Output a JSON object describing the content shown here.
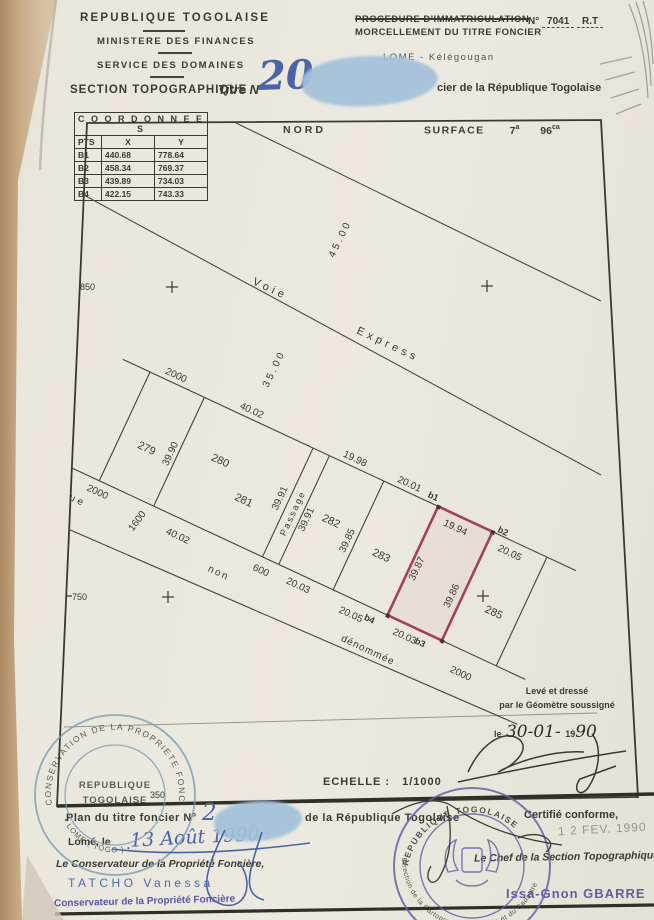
{
  "doc": {
    "header": {
      "country": "REPUBLIQUE TOGOLAISE",
      "ministry": "MINISTERE DES FINANCES",
      "service": "SERVICE DES DOMAINES",
      "procedure": "PROCEDURE D'IMMATRICULATION",
      "morcellement": "MORCELLEMENT DU TITRE FONCIER",
      "num_label": "N°",
      "num_value": "7041",
      "num_suffix": "R.T",
      "location": "LOME - Kélégougan",
      "section": "SECTION TOPOGRAPHIQUE",
      "titre_label": "Titre N°",
      "titre_number": "20",
      "titre_rest": "cier de la République Togolaise"
    },
    "coords": {
      "title": "C O O R D O N N E E S",
      "col_pts": "PTS",
      "col_x": "X",
      "col_y": "Y",
      "rows": [
        {
          "pt": "B1",
          "x": "440.68",
          "y": "778.64"
        },
        {
          "pt": "B2",
          "x": "458.34",
          "y": "769.37"
        },
        {
          "pt": "B3",
          "x": "439.89",
          "y": "734.03"
        },
        {
          "pt": "B4",
          "x": "422.15",
          "y": "743.33"
        }
      ]
    },
    "plan": {
      "north": "NORD",
      "surface_label": "SURFACE",
      "surface_a": "7",
      "surface_a_unit": "a",
      "surface_ca": "96",
      "surface_ca_unit": "ca",
      "grid": {
        "g850": "850",
        "g750": "750",
        "g350": "350"
      },
      "roads": {
        "voie": "Voie",
        "express": "Express",
        "rue": "Rue",
        "non": "non",
        "denommee": "dénommée",
        "passage": "Passage"
      },
      "dims": {
        "d4500": "45.00",
        "d3500": "35.00",
        "p279_top": "2000",
        "p279_bottom": "2000",
        "d3990": "39.90",
        "p28081_top": "40.02",
        "street_4002": "40.02",
        "d3991_left": "39.91",
        "d3991_right": "39.91",
        "passage_w": "600",
        "p282_top": "19.98",
        "p282_bottom": "20.03",
        "d3985": "39.85",
        "p283_top": "20.01",
        "p283_bottom": "20.05",
        "red_top": "19.94",
        "red_left": "39.87",
        "red_right": "39.86",
        "red_bottom": "20.03",
        "p285_top": "20.05",
        "p285_bottom": "2000",
        "street_1600": "1600"
      },
      "parcels": {
        "n279": "279",
        "n280": "280",
        "n281": "281",
        "n282": "282",
        "n283": "283",
        "n285": "285"
      },
      "points": {
        "b1": "b1",
        "b2": "b2",
        "b3": "b3",
        "b4": "b4"
      },
      "red_color": "#a34156"
    },
    "survey_note": {
      "line1": "Levé et dressé",
      "line2": "par le Géomètre soussigné",
      "date_le": "le",
      "date_hand1": "30-01-",
      "date_print": "19",
      "date_hand2": "90"
    },
    "scale": {
      "label": "ECHELLE :",
      "value": "1/1000"
    },
    "footer": {
      "plan_label": "Plan du titre foncier N°",
      "plan_number": "2",
      "plan_rest": "de la République Togolaise",
      "certifie": "Certifié conforme,",
      "date_stamp": "1 2  FEV. 1990",
      "lome_le": "Lomé, le",
      "date_hand": "13 Août 1990 -",
      "conservateur_title": "Le Conservateur de la Propriété Foncière,",
      "conservateur_name": "TATCHO Vanessa",
      "conservateur_stamp": "Conservateur de la Propriété Foncière",
      "chef_title": "Le Chef de la Section Topographique.",
      "chef_name": "Issa-Gnon GBARRE"
    },
    "stamps": {
      "blue": {
        "ring": "CONSERVATION DE LA PROPRIETE FONCIERE",
        "bottom": "• LOME ( TOGO ) •",
        "center1": "REPUBLIQUE",
        "center2": "TOGOLAISE"
      },
      "purple": {
        "top": "REPUBLIQUE TOGOLAISE",
        "bottom": "Direction de la Cartographie Nationale et du Cadastre"
      }
    }
  }
}
